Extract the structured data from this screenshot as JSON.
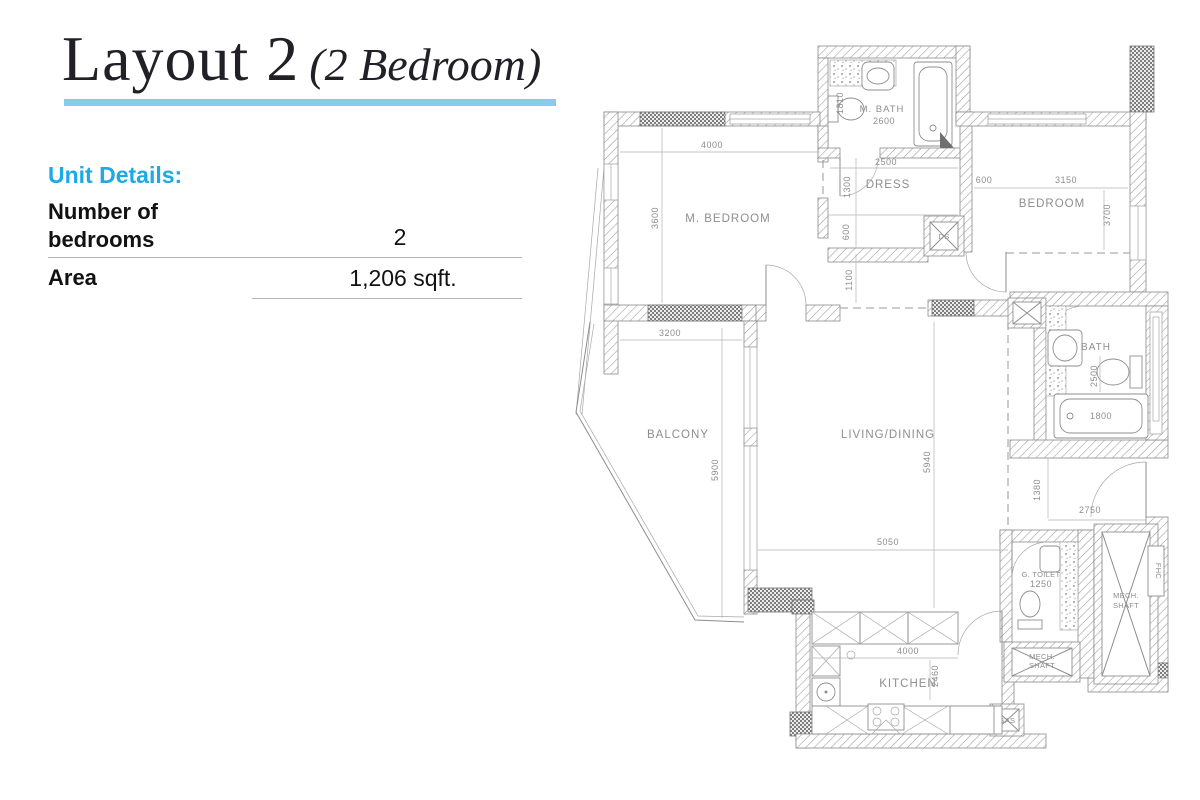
{
  "title": {
    "main": "Layout 2",
    "sub": "(2 Bedroom)"
  },
  "unit_details": {
    "heading": "Unit Details:",
    "rows": [
      {
        "label": "Number of bedrooms",
        "value": "2"
      },
      {
        "label": "Area",
        "value": "1,206 sqft."
      }
    ]
  },
  "colors": {
    "accent": "#1caae6",
    "underline": "#84cdee",
    "plan_gray": "#8e8e8e"
  },
  "floorplan": {
    "rooms": {
      "m_bedroom": "M. BEDROOM",
      "m_bath": "M. BATH",
      "dress": "DRESS",
      "bedroom": "BEDROOM",
      "balcony": "BALCONY",
      "living": "LIVING/DINING",
      "bath": "BATH",
      "kitchen": "KITCHEN",
      "g_toilet": "G. TOILET",
      "mech_line1": "MECH.",
      "mech_line2": "SHAFT",
      "fhc": "FHC",
      "gas": "GAS",
      "ds": "DS"
    },
    "dims": {
      "m_bedroom_w": "4000",
      "m_bedroom_h": "3600",
      "m_bath_w": "2600",
      "m_bath_h": "1810",
      "dress_w": "2500",
      "dress_h1": "1300",
      "dress_h2": "600",
      "bedroom_off": "600",
      "bedroom_w": "3150",
      "bedroom_h": "3700",
      "hall_w": "1100",
      "balcony_w": "3200",
      "balcony_h": "5900",
      "living_h": "5940",
      "living_w": "5050",
      "bath_h": "2500",
      "tub_w": "1800",
      "foyer_h": "1380",
      "foyer_w": "2750",
      "g_toilet_w": "1250",
      "kitchen_w": "4000",
      "kitchen_h": "2460"
    }
  }
}
